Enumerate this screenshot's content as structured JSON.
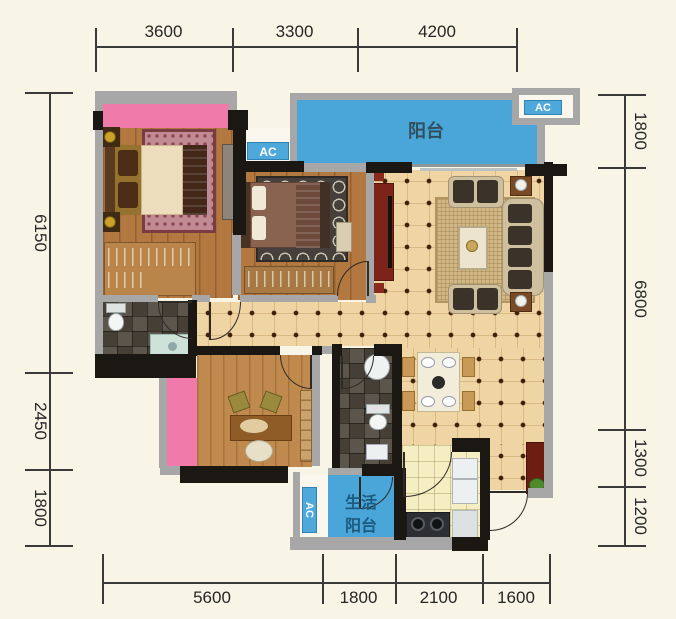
{
  "dimensions": {
    "top": [
      "3600",
      "3300",
      "4200"
    ],
    "left": [
      "6150",
      "2450",
      "1800"
    ],
    "right": [
      "1800",
      "6800",
      "1300",
      "1200"
    ],
    "bottom": [
      "5600",
      "1800",
      "2100",
      "1600"
    ]
  },
  "labels": {
    "balcony": "阳台",
    "service_line1": "生活",
    "service_line2": "阳台",
    "ac": "AC"
  },
  "colors": {
    "balcony_blue": "#4aa5d8",
    "bay_pink": "#f07aa9",
    "wall_dark": "#1b1713",
    "wall_gray": "#a7a7a7",
    "tile_floor": "#eed5a3",
    "wood_floor": "#b2783f",
    "kitchen_floor": "#f5eec3",
    "dimension_text": "#262626"
  }
}
